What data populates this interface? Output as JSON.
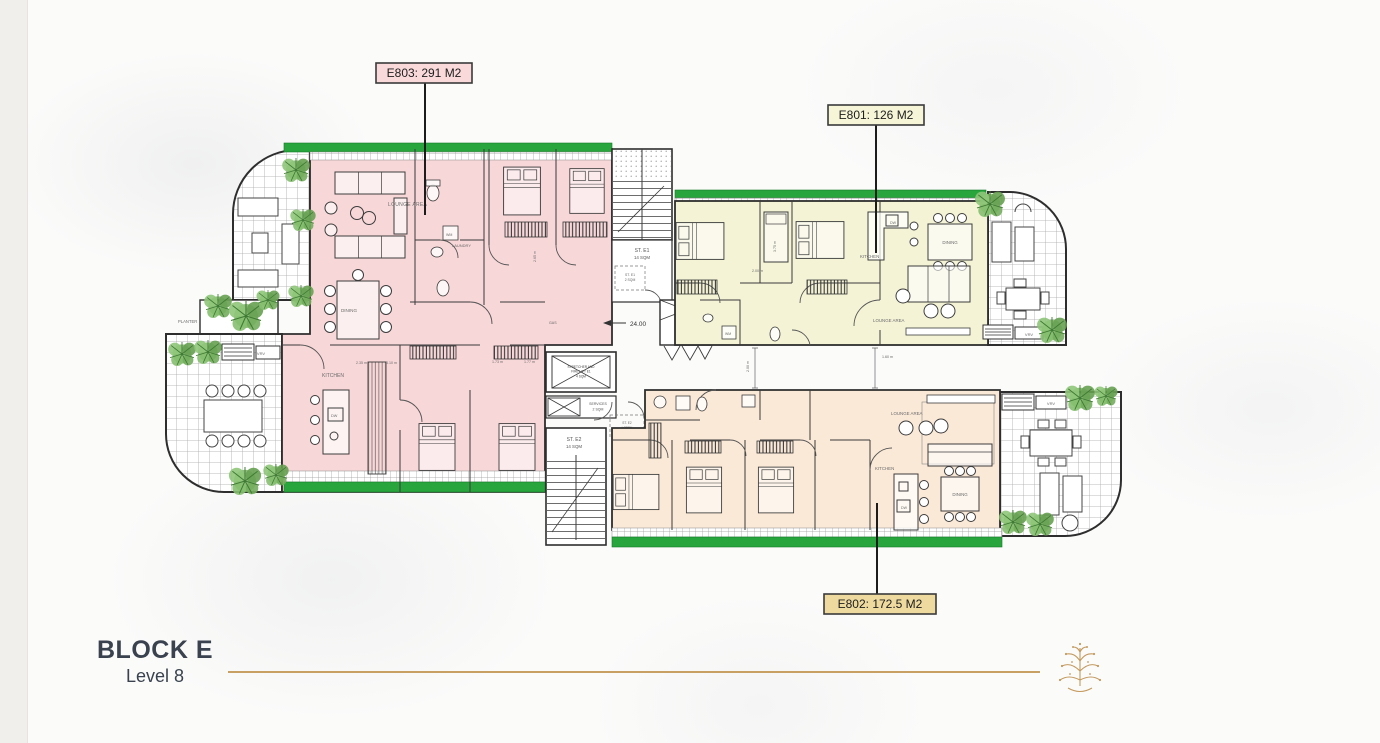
{
  "units": {
    "e803": {
      "label": "E803: 291 M2",
      "fill": "#f8d7d8",
      "tag_bg": "#f9d9da"
    },
    "e801": {
      "label": "E801: 126 M2",
      "fill": "#f4f3d6",
      "tag_bg": "#f6f5d8"
    },
    "e802": {
      "label": "E802: 172.5 M2",
      "fill": "#fbe9d7",
      "tag_bg": "#eeda9f"
    }
  },
  "rooms": {
    "lounge": "LOUNGE AREA",
    "dining": "DINING",
    "kitchen": "KITCHEN",
    "laundry": "LAUNDRY",
    "planter": "PLANTER",
    "vrv": "VRV",
    "wm": "WM",
    "dw": "DW"
  },
  "core": {
    "st_e1": "ST. E1",
    "st_e1_area": "14 SQM",
    "st_e1_lobby": "ST. E1",
    "st_e1_lobby_area": "2 SQM",
    "st_e2": "ST. E2",
    "st_e2_area": "14 SQM",
    "lobby1": "ST. E2",
    "lobby2": "LOBBY",
    "services": "SERVICES",
    "services4_area": "4 SQM",
    "services2": "SERVICES",
    "services2_area": "2 SQM",
    "lift1": "STRETCHER AND",
    "lift2": "FIRE LIFT E1",
    "lift_area": "4 SQM",
    "dim_24": "24.00",
    "gas": "GAS"
  },
  "dims": {
    "d1": "2.00 m",
    "d2": "3.75 m",
    "d3": "1.60 m",
    "d4": "1.73 m",
    "d5": "1.77 m",
    "d6": "3.10 m",
    "d7": "2.35 m",
    "d8": "2.65 m"
  },
  "footer": {
    "title": "BLOCK E",
    "subtitle": "Level 8"
  },
  "colors": {
    "gold": "#c9a063",
    "green": "#28a63d",
    "wall": "#2e2e2e",
    "pink": "#f8d7d8",
    "cream": "#f4f3d6",
    "peach": "#fbe9d7"
  }
}
